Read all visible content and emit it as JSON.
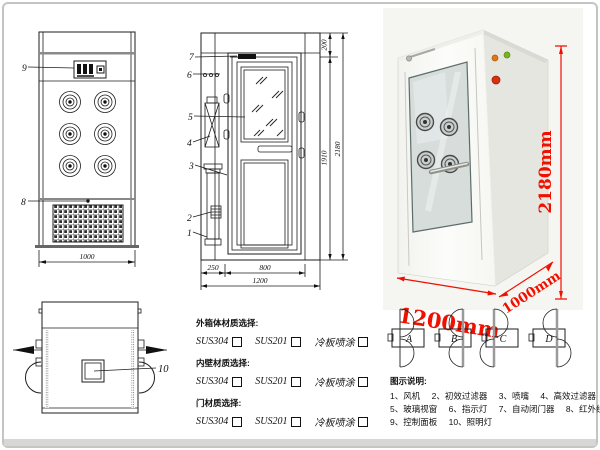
{
  "front_view": {
    "callout_9": "9",
    "callout_8": "8",
    "dim_width": "1000"
  },
  "side_view": {
    "callout_7": "7",
    "callout_6": "6",
    "callout_5": "5",
    "callout_4": "4",
    "callout_3": "3",
    "callout_2": "2",
    "callout_1": "1",
    "dim_top": "200",
    "dim_inner": "1910",
    "dim_total": "2180",
    "dim_left": "250",
    "dim_door": "800",
    "dim_bottom": "1200"
  },
  "top_view": {
    "callout_10": "10"
  },
  "photo": {
    "dim_height": "2180mm",
    "dim_width": "1200mm",
    "dim_depth": "1000mm"
  },
  "materials": {
    "groups": [
      {
        "title": "外箱体材质选择:",
        "options": [
          "SUS304",
          "SUS201",
          "冷板喷涂"
        ]
      },
      {
        "title": "内壁材质选择:",
        "options": [
          "SUS304",
          "SUS201",
          "冷板喷涂"
        ]
      },
      {
        "title": "门材质选择:",
        "options": [
          "SUS304",
          "SUS201",
          "冷板喷涂"
        ]
      }
    ]
  },
  "door_options": {
    "labels": [
      "A",
      "B",
      "C",
      "D"
    ]
  },
  "legend": {
    "title": "图示说明:",
    "items": [
      "1、风机",
      "2、初效过滤器",
      "3、喷嘴",
      "4、高效过滤器",
      "5、玻璃视窗",
      "6、指示灯",
      "7、自动闭门器",
      "8、红外线感应器",
      "9、控制面板",
      "10、照明灯"
    ]
  },
  "colors": {
    "accent_red": "#ee1000",
    "line": "#1d1d1d"
  }
}
